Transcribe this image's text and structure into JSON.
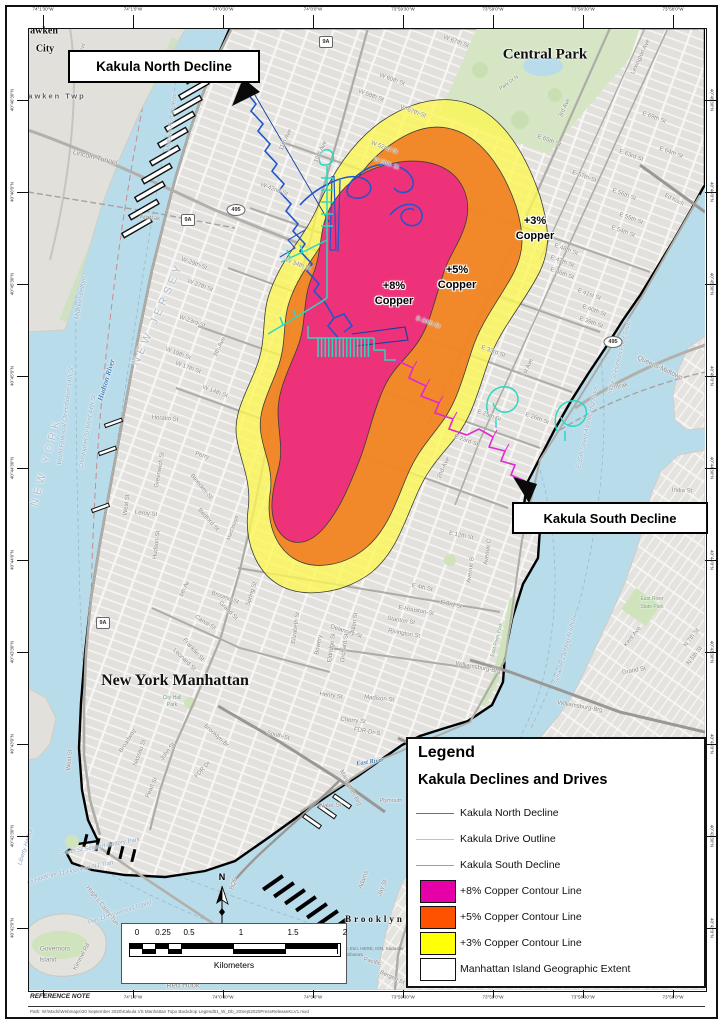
{
  "figure": {
    "callouts": {
      "north": "Kakula North Decline",
      "south": "Kakula South Decline"
    },
    "copper_labels": [
      {
        "pct": "+8%",
        "word": "Copper",
        "x": 394,
        "y": 286
      },
      {
        "pct": "+5%",
        "word": "Copper",
        "x": 457,
        "y": 270
      },
      {
        "pct": "+3%",
        "word": "Copper",
        "x": 535,
        "y": 221
      }
    ],
    "north_arrow_label": "N"
  },
  "legend": {
    "title": "Legend",
    "subtitle": "Kakula Declines and Drives",
    "items": [
      {
        "label": "Kakula North Decline",
        "swatch": "line",
        "color": "#4d7a9b"
      },
      {
        "label": "Kakula Drive Outline",
        "swatch": "line",
        "color": "#7de2d1"
      },
      {
        "label": "Kakula South Decline",
        "swatch": "line",
        "color": "#c97fc9"
      },
      {
        "label": "+8% Copper Contour Line",
        "swatch": "box",
        "color": "#e600a8"
      },
      {
        "label": "+5% Copper Contour Line",
        "swatch": "box",
        "color": "#ff5200"
      },
      {
        "label": "+3% Copper Contour Line",
        "swatch": "box",
        "color": "#ffff05"
      },
      {
        "label": "Manhattan Island Geographic Extent",
        "swatch": "box",
        "color": "#ffffff"
      }
    ]
  },
  "scalebar": {
    "ticks": [
      "0",
      "0.25",
      "0.5",
      "1",
      "1.5",
      "2"
    ],
    "unit": "Kilometers"
  },
  "graticule": {
    "top": [
      "74°1'30\"W",
      "74°1'0\"W",
      "74°0'30\"W",
      "74°0'0\"W",
      "73°59'30\"W",
      "73°59'0\"W",
      "73°58'30\"W",
      "73°58'0\"W"
    ],
    "bottom": [
      "74°1'0\"W",
      "74°0'30\"W",
      "74°0'0\"W",
      "73°59'30\"W",
      "73°59'0\"W",
      "73°58'30\"W",
      "73°58'0\"W"
    ],
    "left": [
      "40°46'30\"N",
      "40°46'0\"N",
      "40°45'30\"N",
      "40°45'0\"N",
      "40°44'30\"N",
      "40°44'0\"N",
      "40°43'30\"N",
      "40°43'0\"N",
      "40°42'30\"N",
      "40°42'0\"N"
    ],
    "right": [
      "40°46'30\"N",
      "40°46'0\"N",
      "40°45'30\"N",
      "40°45'0\"N",
      "40°44'30\"N",
      "40°44'0\"N",
      "40°43'30\"N",
      "40°43'0\"N",
      "40°42'30\"N",
      "40°42'0\"N"
    ]
  },
  "shields": [
    {
      "t": "495",
      "x": 236,
      "y": 210,
      "k": "oval"
    },
    {
      "t": "495",
      "x": 613,
      "y": 342,
      "k": "oval"
    },
    {
      "t": "9A",
      "x": 326,
      "y": 42,
      "k": "sq"
    },
    {
      "t": "9A",
      "x": 188,
      "y": 220,
      "k": "sq"
    },
    {
      "t": "9A",
      "x": 103,
      "y": 623,
      "k": "sq"
    }
  ],
  "notes": {
    "reference": "REFERENCE NOTE",
    "file": "Path: W:\\Mxds\\Webmaps\\30 September 2020\\Kakula VS Manhattan Topo Backdrop Legend51_W_Db_20Sept2020PressReleaseKLV1.mxd",
    "sources": "Sources: Esri, HERE, IGN, Kadaster NL, contributors"
  },
  "places": [
    {
      "t": "awken",
      "x": 44,
      "y": 31,
      "r": 0,
      "c": "big",
      "s": 10
    },
    {
      "t": "City",
      "x": 45,
      "y": 49,
      "r": 0,
      "c": "big",
      "s": 10
    },
    {
      "t": "awken Twp",
      "x": 57,
      "y": 96,
      "r": 0,
      "c": "twp",
      "s": 7.5
    },
    {
      "t": "Lincoln-Tunnel",
      "x": 95,
      "y": 158,
      "r": 14,
      "s": 7
    },
    {
      "t": "Amtrak",
      "x": 150,
      "y": 218,
      "r": 6,
      "s": 6.5
    },
    {
      "t": "JF Kennedy Blvd",
      "x": 80,
      "y": 62,
      "r": -78,
      "s": 5
    },
    {
      "t": "Midtown-Port Imperial",
      "x": 172,
      "y": 122,
      "r": -83,
      "c": "ferry"
    },
    {
      "t": "Midtown-Belford",
      "x": 81,
      "y": 298,
      "r": -80,
      "c": "ferry"
    },
    {
      "t": "World Financial Ctr-Hoboken-14th St",
      "x": 66,
      "y": 416,
      "r": -83,
      "c": "ferry"
    },
    {
      "t": "Christopher St-West 44th St",
      "x": 88,
      "y": 432,
      "r": -80,
      "c": "ferry"
    },
    {
      "t": "NEW JERSEY",
      "x": 158,
      "y": 314,
      "r": -66,
      "c": "state",
      "s": 11
    },
    {
      "t": "NEW YORK",
      "x": 46,
      "y": 462,
      "r": -75,
      "c": "state",
      "s": 11
    },
    {
      "t": "Hudson River",
      "x": 106,
      "y": 380,
      "r": -73,
      "c": "water",
      "s": 7.5
    },
    {
      "t": "Central Park",
      "x": 545,
      "y": 55,
      "r": 0,
      "c": "big",
      "s": 15
    },
    {
      "t": "Park Dr N",
      "x": 509,
      "y": 83,
      "r": -35,
      "s": 5
    },
    {
      "t": "W 67th St",
      "x": 456,
      "y": 42,
      "r": 20
    },
    {
      "t": "W 60th St",
      "x": 392,
      "y": 80,
      "r": 20
    },
    {
      "t": "W 58th St",
      "x": 371,
      "y": 96,
      "r": 20
    },
    {
      "t": "W-57th-St",
      "x": 413,
      "y": 112,
      "r": 20
    },
    {
      "t": "W 52nd St",
      "x": 384,
      "y": 148,
      "r": 20
    },
    {
      "t": "W 50th St",
      "x": 386,
      "y": 164,
      "r": 20
    },
    {
      "t": "11th Ave",
      "x": 286,
      "y": 140,
      "r": -65
    },
    {
      "t": "10th Ave",
      "x": 321,
      "y": 152,
      "r": -65
    },
    {
      "t": "W-42nd-St",
      "x": 274,
      "y": 190,
      "r": 20
    },
    {
      "t": "W 34th St",
      "x": 298,
      "y": 265,
      "r": 20
    },
    {
      "t": "W-29th-St",
      "x": 194,
      "y": 264,
      "r": 20
    },
    {
      "t": "W 27th St",
      "x": 200,
      "y": 286,
      "r": 20
    },
    {
      "t": "W-23rd-St",
      "x": 192,
      "y": 322,
      "r": 20
    },
    {
      "t": "W 19th St",
      "x": 178,
      "y": 354,
      "r": 20
    },
    {
      "t": "W 17th St",
      "x": 188,
      "y": 368,
      "r": 20
    },
    {
      "t": "W 14th St",
      "x": 215,
      "y": 392,
      "r": 20
    },
    {
      "t": "9th-Ave",
      "x": 220,
      "y": 347,
      "r": -65
    },
    {
      "t": "Horatio St",
      "x": 165,
      "y": 419,
      "r": 5
    },
    {
      "t": "Perry",
      "x": 202,
      "y": 456,
      "r": 18
    },
    {
      "t": "Bleecker-St",
      "x": 201,
      "y": 487,
      "r": 50
    },
    {
      "t": "Leroy St",
      "x": 146,
      "y": 514,
      "r": 5
    },
    {
      "t": "Greenwich St",
      "x": 160,
      "y": 470,
      "r": -80
    },
    {
      "t": "West St",
      "x": 127,
      "y": 505,
      "r": -83
    },
    {
      "t": "Hudson-St",
      "x": 157,
      "y": 545,
      "r": -83
    },
    {
      "t": "Bedford St",
      "x": 208,
      "y": 520,
      "r": 48
    },
    {
      "t": "MacDougal",
      "x": 233,
      "y": 528,
      "r": -70,
      "s": 5
    },
    {
      "t": "6th Av",
      "x": 185,
      "y": 589,
      "r": -65
    },
    {
      "t": "Broome-St",
      "x": 225,
      "y": 598,
      "r": 20
    },
    {
      "t": "Canal-St",
      "x": 205,
      "y": 623,
      "r": 32
    },
    {
      "t": "Grand St",
      "x": 228,
      "y": 611,
      "r": 45
    },
    {
      "t": "Spring St",
      "x": 252,
      "y": 594,
      "r": -72
    },
    {
      "t": "Franklin St",
      "x": 193,
      "y": 650,
      "r": 48
    },
    {
      "t": "Leonard St",
      "x": 184,
      "y": 660,
      "r": 44
    },
    {
      "t": "New York Manhattan",
      "x": 175,
      "y": 681,
      "r": 0,
      "c": "big",
      "s": 16
    },
    {
      "t": "City Hall",
      "x": 172,
      "y": 698,
      "r": 0,
      "c": "green",
      "s": 5
    },
    {
      "t": "Park",
      "x": 172,
      "y": 705,
      "r": 0,
      "c": "green",
      "s": 5
    },
    {
      "t": "Broadway",
      "x": 128,
      "y": 741,
      "r": -58
    },
    {
      "t": "Nassau St",
      "x": 140,
      "y": 753,
      "r": -70
    },
    {
      "t": "John St",
      "x": 168,
      "y": 752,
      "r": -52
    },
    {
      "t": "Pearl St",
      "x": 152,
      "y": 788,
      "r": -66
    },
    {
      "t": "West St",
      "x": 70,
      "y": 760,
      "r": -85
    },
    {
      "t": "E-Houston-St",
      "x": 416,
      "y": 611,
      "r": 10
    },
    {
      "t": "Stanton St",
      "x": 401,
      "y": 621,
      "r": 10
    },
    {
      "t": "Rivington St",
      "x": 404,
      "y": 634,
      "r": 10
    },
    {
      "t": "Delancey-St",
      "x": 346,
      "y": 632,
      "r": 18
    },
    {
      "t": "Bowery",
      "x": 319,
      "y": 645,
      "r": -80
    },
    {
      "t": "Elizabeth St",
      "x": 296,
      "y": 628,
      "r": -82
    },
    {
      "t": "Eldridge St",
      "x": 332,
      "y": 648,
      "r": -82
    },
    {
      "t": "Orchard St",
      "x": 345,
      "y": 648,
      "r": -82
    },
    {
      "t": "Allen St",
      "x": 355,
      "y": 623,
      "r": -82
    },
    {
      "t": "Henry St",
      "x": 331,
      "y": 696,
      "r": 8
    },
    {
      "t": "Madison St",
      "x": 379,
      "y": 699,
      "r": 6
    },
    {
      "t": "Cherry St",
      "x": 353,
      "y": 721,
      "r": 6
    },
    {
      "t": "South-St",
      "x": 278,
      "y": 736,
      "r": 15
    },
    {
      "t": "FDR-Dr-S",
      "x": 367,
      "y": 732,
      "r": 10
    },
    {
      "t": "FDR Dr",
      "x": 203,
      "y": 770,
      "r": -48
    },
    {
      "t": "Water St",
      "x": 330,
      "y": 806,
      "r": -3
    },
    {
      "t": "Plymouth",
      "x": 391,
      "y": 801,
      "r": 0,
      "s": 5.5
    },
    {
      "t": "East River",
      "x": 370,
      "y": 762,
      "r": -8,
      "c": "water",
      "s": 6.5
    },
    {
      "t": "Manhattan-Brg",
      "x": 350,
      "y": 788,
      "r": 62,
      "s": 6
    },
    {
      "t": "Brooklyn-Br",
      "x": 216,
      "y": 736,
      "r": 42,
      "s": 6
    },
    {
      "t": "Williamsburg-Brg",
      "x": 478,
      "y": 668,
      "r": 10,
      "s": 6
    },
    {
      "t": "Williamsburg-Brg",
      "x": 580,
      "y": 707,
      "r": 10,
      "s": 6
    },
    {
      "t": "Ed Koch",
      "x": 674,
      "y": 200,
      "r": 28,
      "s": 5.5
    },
    {
      "t": "Queens-Midtown",
      "x": 660,
      "y": 368,
      "r": 25,
      "s": 6.5
    },
    {
      "t": "Amtrak",
      "x": 618,
      "y": 387,
      "r": -15,
      "s": 6.5
    },
    {
      "t": "E 69th St",
      "x": 654,
      "y": 118,
      "r": 20
    },
    {
      "t": "E 65th St",
      "x": 549,
      "y": 141,
      "r": 20
    },
    {
      "t": "E 64th St",
      "x": 671,
      "y": 153,
      "r": 20
    },
    {
      "t": "E 63rd St",
      "x": 631,
      "y": 156,
      "r": 20
    },
    {
      "t": "Lexington Ave",
      "x": 641,
      "y": 57,
      "r": -65
    },
    {
      "t": "3rd Ave",
      "x": 565,
      "y": 108,
      "r": -65
    },
    {
      "t": "E-57th-St",
      "x": 584,
      "y": 177,
      "r": 20
    },
    {
      "t": "E 56th St",
      "x": 624,
      "y": 195,
      "r": 20
    },
    {
      "t": "E 55th St",
      "x": 631,
      "y": 219,
      "r": 20
    },
    {
      "t": "E 54th St",
      "x": 623,
      "y": 232,
      "r": 20
    },
    {
      "t": "E 48th St",
      "x": 566,
      "y": 250,
      "r": 20
    },
    {
      "t": "E 47th St",
      "x": 562,
      "y": 262,
      "r": 20
    },
    {
      "t": "E 46th St",
      "x": 562,
      "y": 274,
      "r": 20
    },
    {
      "t": "E 41st St",
      "x": 589,
      "y": 295,
      "r": 20
    },
    {
      "t": "E 40th St",
      "x": 594,
      "y": 311,
      "r": 20
    },
    {
      "t": "E 39th St",
      "x": 591,
      "y": 323,
      "r": 20
    },
    {
      "t": "E-34th-St",
      "x": 428,
      "y": 323,
      "r": 20
    },
    {
      "t": "E 33rd St",
      "x": 493,
      "y": 352,
      "r": 20
    },
    {
      "t": "1st Ave",
      "x": 528,
      "y": 368,
      "r": -65
    },
    {
      "t": "2nd-Ave",
      "x": 444,
      "y": 468,
      "r": -65
    },
    {
      "t": "E 26th St",
      "x": 537,
      "y": 419,
      "r": 20
    },
    {
      "t": "E 25th St",
      "x": 489,
      "y": 416,
      "r": 20
    },
    {
      "t": "E 23rd St",
      "x": 466,
      "y": 441,
      "r": 20
    },
    {
      "t": "E 12th St",
      "x": 461,
      "y": 536,
      "r": 12
    },
    {
      "t": "Avenue C",
      "x": 488,
      "y": 552,
      "r": -82
    },
    {
      "t": "Avenue B",
      "x": 471,
      "y": 570,
      "r": -82
    },
    {
      "t": "E 4th St",
      "x": 422,
      "y": 588,
      "r": 12
    },
    {
      "t": "E 3rd St",
      "x": 451,
      "y": 605,
      "r": 12
    },
    {
      "t": "East River Park",
      "x": 497,
      "y": 640,
      "r": -75,
      "c": "green",
      "s": 5
    },
    {
      "t": "E 35th Street-Atlantic Highlands",
      "x": 588,
      "y": 427,
      "r": -78,
      "c": "ferry"
    },
    {
      "t": "India St-Hunters Point South",
      "x": 620,
      "y": 357,
      "r": -75,
      "c": "ferry"
    },
    {
      "t": "Schaefer Landing-N 6th St",
      "x": 566,
      "y": 650,
      "r": -75,
      "c": "ferry"
    },
    {
      "t": "India St",
      "x": 682,
      "y": 491,
      "r": 3
    },
    {
      "t": "Noble",
      "x": 690,
      "y": 531,
      "r": 3
    },
    {
      "t": "East River",
      "x": 652,
      "y": 599,
      "r": 0,
      "c": "green",
      "s": 5
    },
    {
      "t": "State Park",
      "x": 652,
      "y": 607,
      "r": 0,
      "c": "green",
      "s": 5
    },
    {
      "t": "Kent Ave",
      "x": 633,
      "y": 637,
      "r": -52
    },
    {
      "t": "N 7th St",
      "x": 692,
      "y": 638,
      "r": -52
    },
    {
      "t": "N 5th St",
      "x": 695,
      "y": 656,
      "r": -52
    },
    {
      "t": "Grand St",
      "x": 634,
      "y": 671,
      "r": -10
    },
    {
      "t": "Brooklyn",
      "x": 640,
      "y": 908,
      "r": 0,
      "c": "big",
      "s": 11,
      "ls": 5
    },
    {
      "t": "Brooklyn",
      "x": 375,
      "y": 919,
      "r": 0,
      "c": "big",
      "s": 9,
      "ls": 3
    },
    {
      "t": "Joralemon St",
      "x": 565,
      "y": 906,
      "r": 8
    },
    {
      "t": "Schermerhorn St",
      "x": 612,
      "y": 938,
      "r": 22
    },
    {
      "t": "Pacific",
      "x": 372,
      "y": 962,
      "r": 15
    },
    {
      "t": "Bergen St",
      "x": 392,
      "y": 978,
      "r": 25
    },
    {
      "t": "BQE",
      "x": 234,
      "y": 884,
      "r": -70
    },
    {
      "t": "Adams",
      "x": 364,
      "y": 880,
      "r": -70
    },
    {
      "t": "Jay St",
      "x": 383,
      "y": 888,
      "r": -68
    },
    {
      "t": "South St Seaport-Battery Park",
      "x": 100,
      "y": 847,
      "r": -10,
      "c": "ferry"
    },
    {
      "t": "Pier 11-Hoboken-NJ-Tran",
      "x": 80,
      "y": 870,
      "r": -12,
      "c": "ferry"
    },
    {
      "t": "Pier 11-Governors Island",
      "x": 120,
      "y": 913,
      "r": -18,
      "c": "ferry"
    },
    {
      "t": "Liberty Harbor",
      "x": 26,
      "y": 847,
      "r": -72,
      "c": "ferry"
    },
    {
      "t": "us Hook",
      "x": 38,
      "y": 880,
      "r": -20,
      "c": "ferry"
    },
    {
      "t": "Hugh L Carey Tun",
      "x": 102,
      "y": 906,
      "r": 52
    },
    {
      "t": "Kimmel Rd",
      "x": 82,
      "y": 957,
      "r": -62
    },
    {
      "t": "Governors",
      "x": 55,
      "y": 949,
      "r": 0,
      "s": 6.5
    },
    {
      "t": "Island",
      "x": 48,
      "y": 960,
      "r": 0,
      "s": 6.5
    },
    {
      "t": "Red Hook",
      "x": 183,
      "y": 985,
      "r": 0,
      "s": 7.5
    }
  ]
}
